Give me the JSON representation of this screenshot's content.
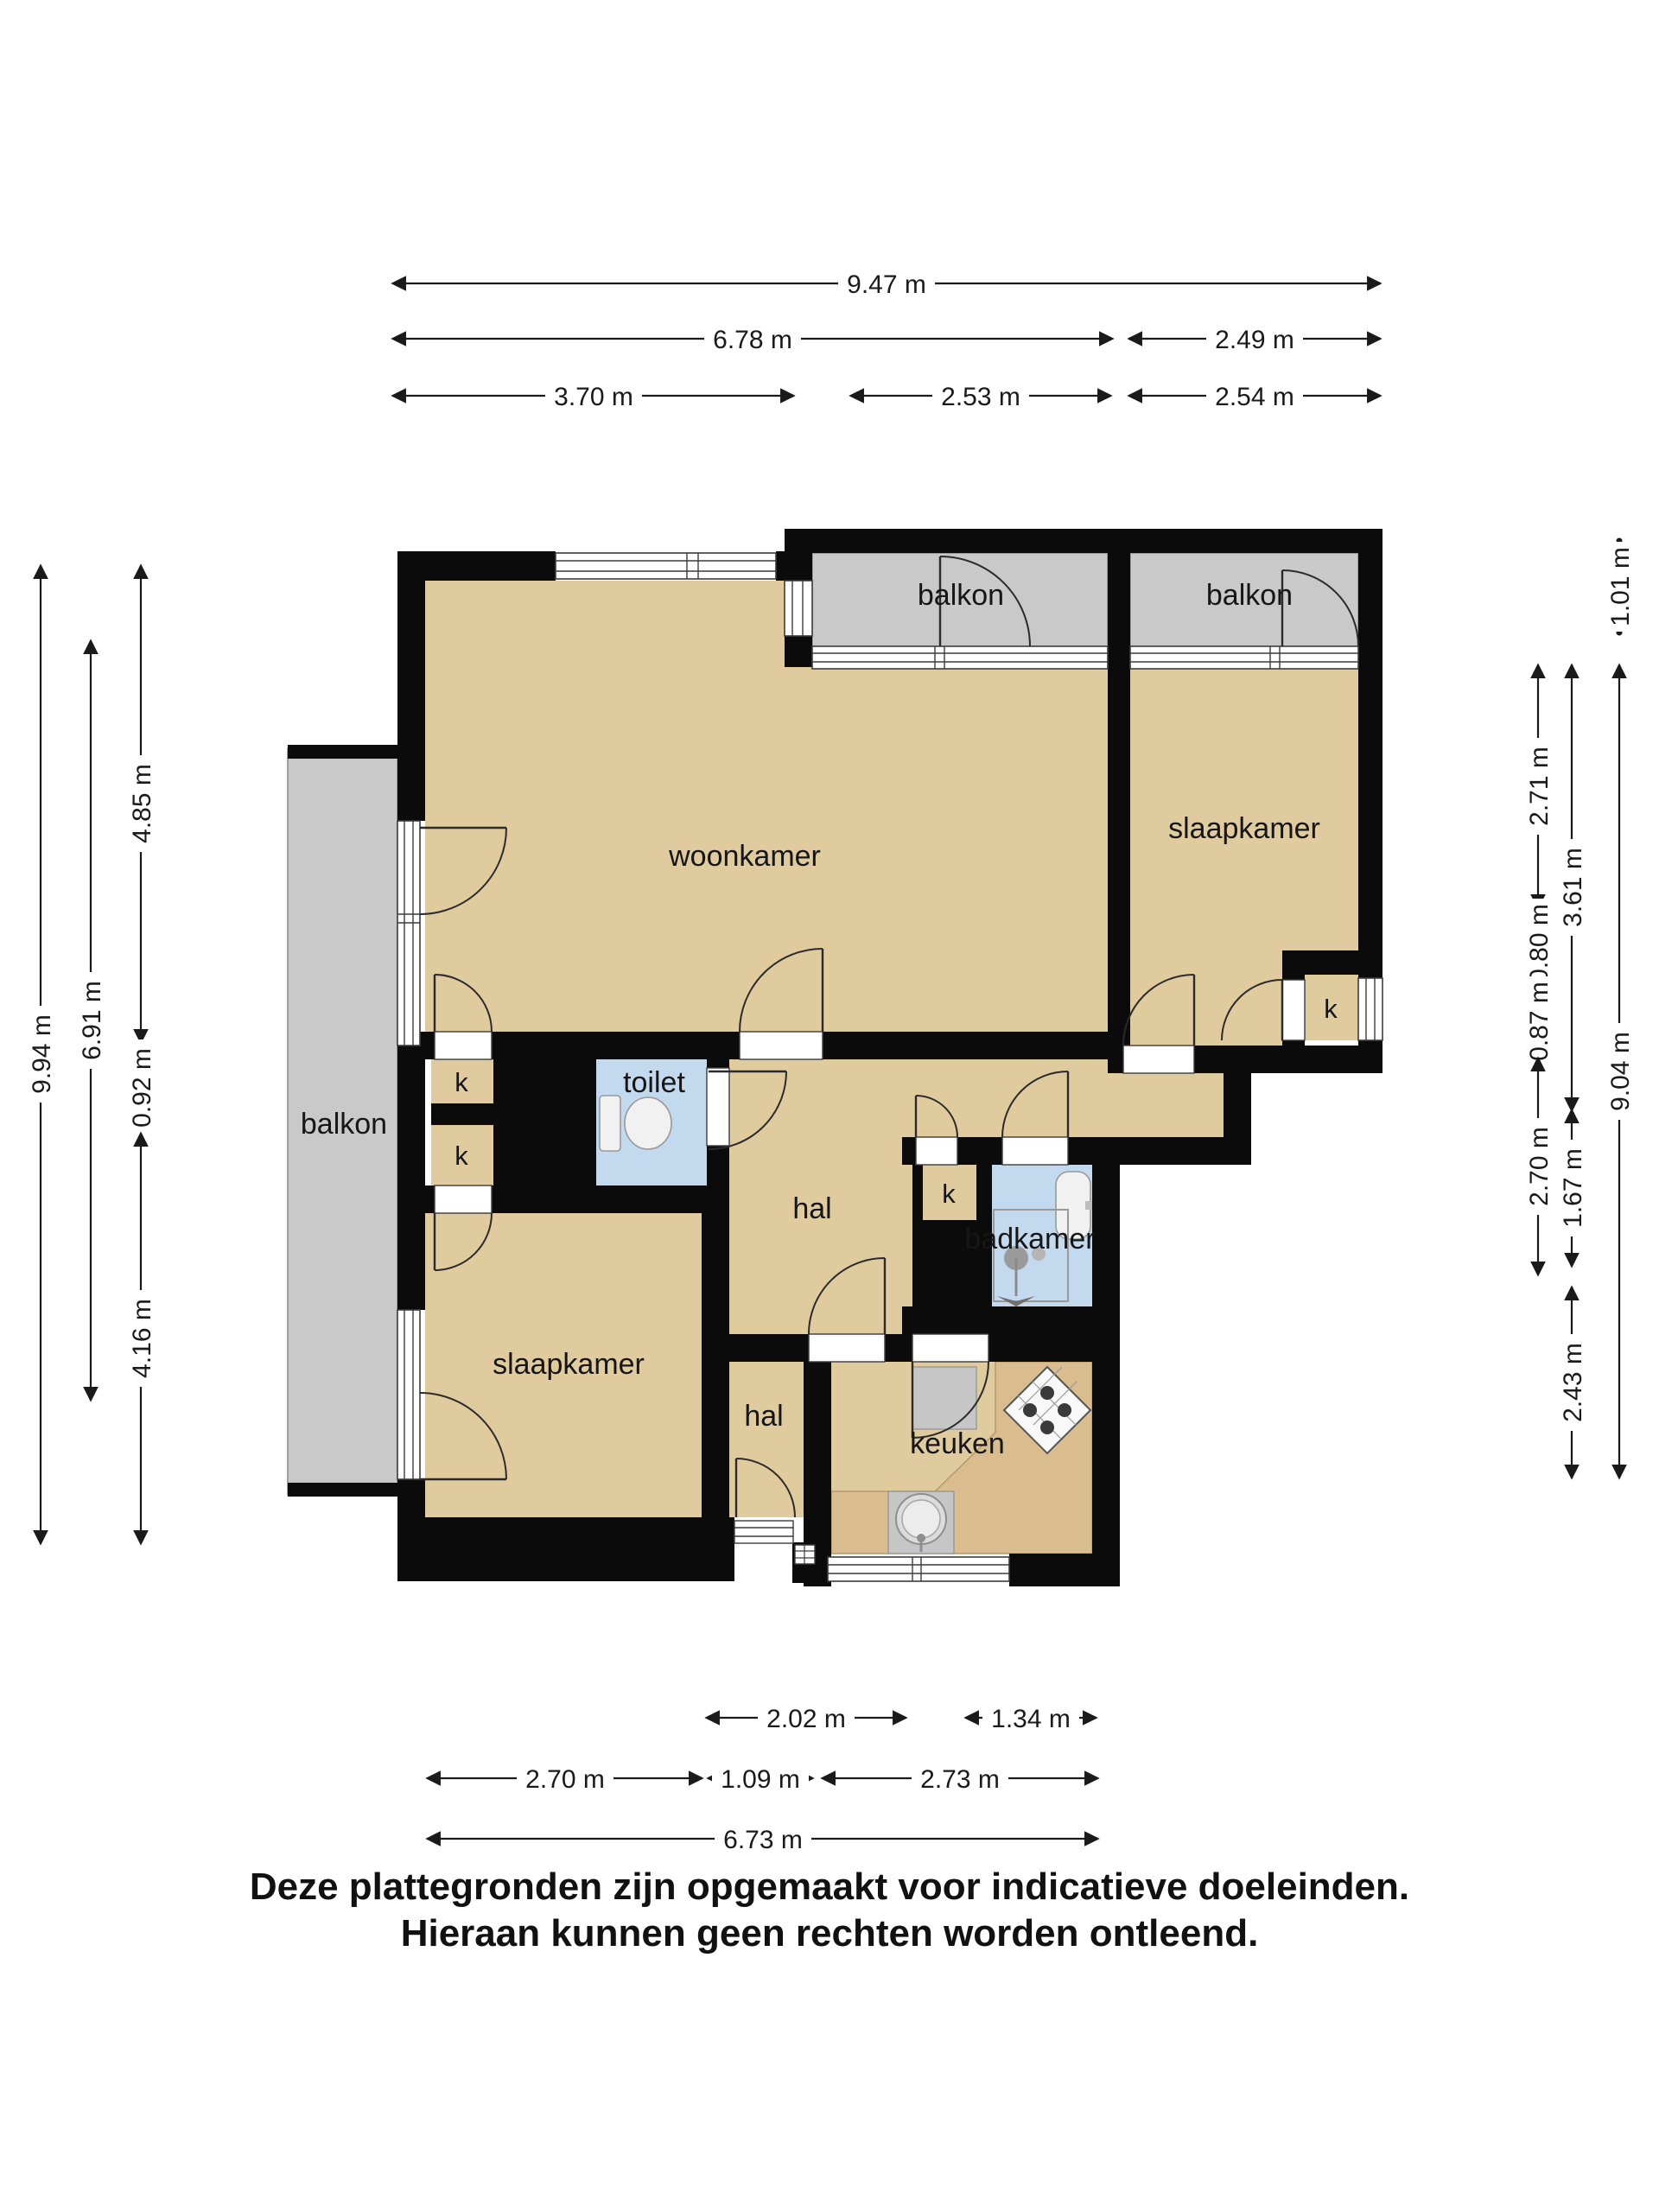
{
  "rooms": {
    "woonkamer": "woonkamer",
    "slaapkamer": "slaapkamer",
    "balkon": "balkon",
    "toilet": "toilet",
    "hal": "hal",
    "badkamer": "badkamer",
    "keuken": "keuken",
    "kast": "k"
  },
  "dimensions": {
    "top": [
      "9.47 m",
      "6.78 m",
      "2.49 m",
      "3.70 m",
      "2.53 m",
      "2.54 m"
    ],
    "bottom": [
      "2.02 m",
      "1.34 m",
      "2.70 m",
      "1.09 m",
      "2.73 m",
      "6.73 m"
    ],
    "left": [
      "9.94 m",
      "6.91 m",
      "4.85 m",
      "0.92 m",
      "4.16 m"
    ],
    "right": [
      "1.01 m",
      "2.71 m",
      "0.80 m",
      "0.87 m",
      "2.70 m",
      "3.61 m",
      "1.67 m",
      "2.43 m",
      "9.04 m"
    ]
  },
  "disclaimer": {
    "line1": "Deze plattegronden zijn opgemaakt voor indicatieve doeleinden.",
    "line2": "Hieraan kunnen geen rechten worden ontleend."
  },
  "colors": {
    "wall": "#0b0b0b",
    "floor": "#e0cb9f",
    "balcony": "#c9c9c9",
    "wet": "#c3d9ee",
    "counter": "#dabd8e",
    "text": "#1a1a1a"
  }
}
